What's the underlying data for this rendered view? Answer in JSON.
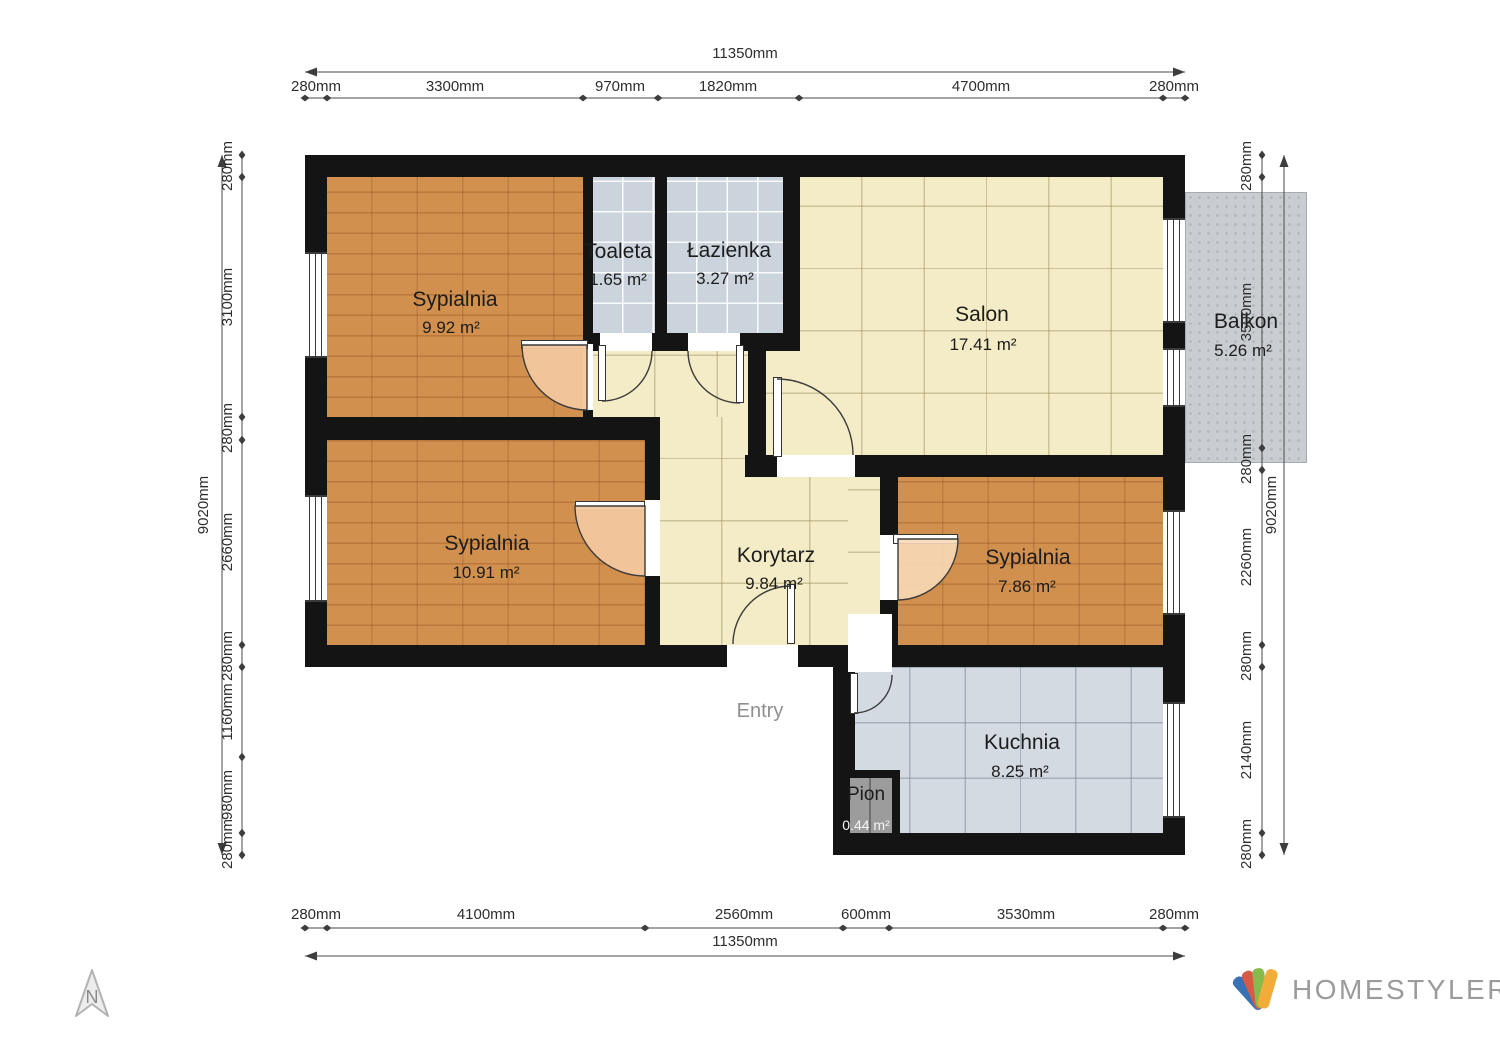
{
  "branding": {
    "logo_text": "HOMESTYLER",
    "north_label": "N"
  },
  "plan": {
    "entry_label": "Entry"
  },
  "rooms": {
    "bedroom_top": {
      "name": "Sypialnia",
      "area": "9.92 m²"
    },
    "toilet": {
      "name": "Toaleta",
      "area": "1.65 m²"
    },
    "bathroom": {
      "name": "Łazienka",
      "area": "3.27 m²"
    },
    "living_room": {
      "name": "Salon",
      "area": "17.41 m²"
    },
    "balcony": {
      "name": "Balkon",
      "area": "5.26 m²"
    },
    "bedroom_left": {
      "name": "Sypialnia",
      "area": "10.91 m²"
    },
    "corridor": {
      "name": "Korytarz",
      "area": "9.84 m²"
    },
    "bedroom_right": {
      "name": "Sypialnia",
      "area": "7.86 m²"
    },
    "kitchen": {
      "name": "Kuchnia",
      "area": "8.25 m²"
    },
    "shaft": {
      "name": "Pion",
      "area": "0.44 m²"
    }
  },
  "dimensions": {
    "top": {
      "total": "11350mm",
      "segments": [
        "280mm",
        "3300mm",
        "970mm",
        "1820mm",
        "4700mm",
        "280mm"
      ]
    },
    "bottom": {
      "total": "11350mm",
      "segments": [
        "280mm",
        "4100mm",
        "2560mm",
        "600mm",
        "3530mm",
        "280mm"
      ]
    },
    "left": {
      "total": "9020mm",
      "segments": [
        "280mm",
        "3100mm",
        "280mm",
        "2660mm",
        "280mm",
        "1160mm",
        "980mm",
        "280mm"
      ]
    },
    "right": {
      "total": "9020mm",
      "segments": [
        "280mm",
        "3500mm",
        "280mm",
        "2260mm",
        "280mm",
        "2140mm",
        "280mm"
      ]
    }
  },
  "colors": {
    "wall": "#141414",
    "wood_floor": "#d2904f",
    "tile_cream": "#f4ecc6",
    "tile_blue": "#cbd3dc",
    "tile_kitchen": "#d3dae1",
    "balcony": "#c9cdd2",
    "dimension_text": "#2e2e2e",
    "logo_text_color": "#9b9b9b",
    "logo_blades": [
      "#3a70b4",
      "#d75a47",
      "#86ba4d",
      "#f2ac39"
    ]
  }
}
